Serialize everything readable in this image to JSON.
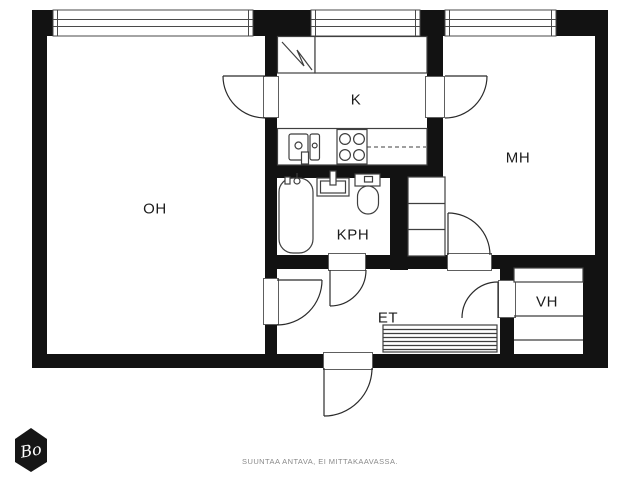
{
  "plan": {
    "rooms": {
      "oh": {
        "label": "OH",
        "name": "living-room"
      },
      "k": {
        "label": "K",
        "name": "kitchen"
      },
      "mh": {
        "label": "MH",
        "name": "bedroom"
      },
      "kph": {
        "label": "KPH",
        "name": "bathroom"
      },
      "et": {
        "label": "ET",
        "name": "entry-hall"
      },
      "vh": {
        "label": "VH",
        "name": "walk-in-closet"
      }
    }
  },
  "footer": {
    "disclaimer": "SUUNTAA ANTAVA, EI MITTAKAAVASSA."
  },
  "logo": {
    "text": "Bo"
  },
  "colors": {
    "wall": "#121212",
    "fixture": "#3f3f3f",
    "door": "#2b2b2b",
    "window": "#4a4a4a",
    "jamb": "#5e5e5e",
    "label": "#1c1c1c",
    "disclaimer": "#8a8a8a",
    "logo_bg": "#161616",
    "logo_text": "#ffffff",
    "background": "#ffffff"
  }
}
